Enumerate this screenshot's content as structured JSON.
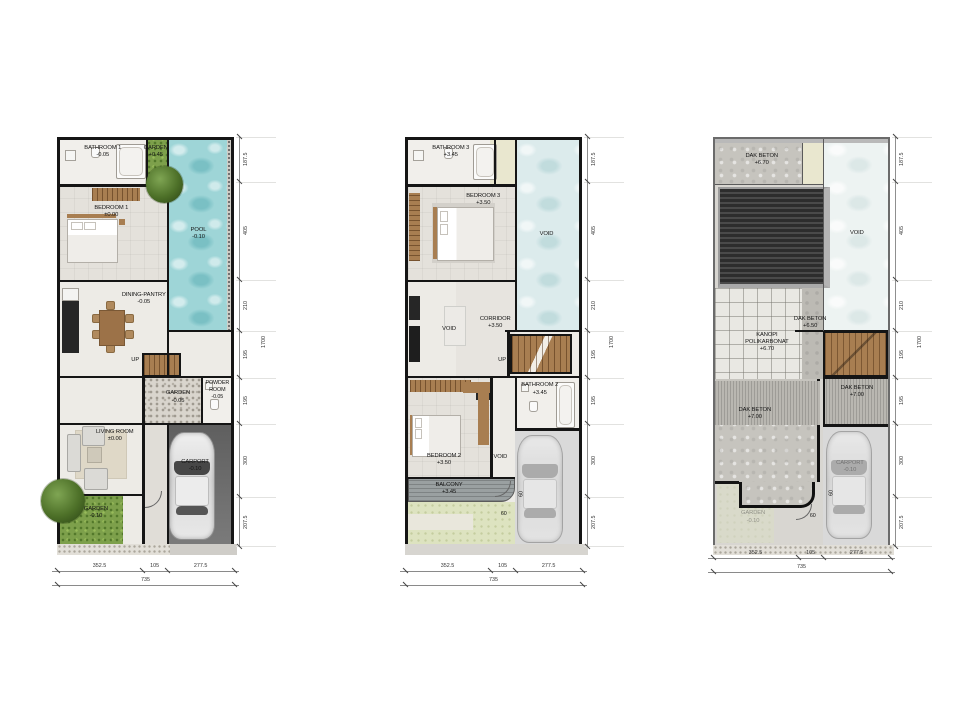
{
  "dims": {
    "right": [
      "187.5",
      "405",
      "210",
      "195",
      "195",
      "300",
      "207.5"
    ],
    "right_total": "1700",
    "bottom": [
      "352.5",
      "105",
      "277.5"
    ],
    "bottom_total": "735",
    "offset": "60"
  },
  "plans": [
    {
      "rooms": {
        "bathroom1": {
          "name": "BATHROOM 1",
          "level": "-0.05"
        },
        "garden_top": {
          "name": "GARDEN",
          "level": "+0.45"
        },
        "bedroom1": {
          "name": "BEDROOM 1",
          "level": "±0.00"
        },
        "pool": {
          "name": "POOL",
          "level": "-0.10"
        },
        "dining": {
          "name": "DINING-PANTRY",
          "level": "-0.05"
        },
        "stairs": {
          "name": "UP"
        },
        "garden_mid": {
          "name": "GARDEN",
          "level": "-0.05"
        },
        "powder": {
          "name": "POWDER ROOM",
          "level": "-0.05"
        },
        "living": {
          "name": "LIVING ROOM",
          "level": "±0.00"
        },
        "carport": {
          "name": "CARPORT",
          "level": "-0.10"
        },
        "garden_bottom": {
          "name": "GARDEN",
          "level": "-0.10"
        }
      }
    },
    {
      "rooms": {
        "bathroom3": {
          "name": "BATHROOM 3",
          "level": "+3.45"
        },
        "bedroom3": {
          "name": "BEDROOM 3",
          "level": "+3.50"
        },
        "void_pool": {
          "name": "VOID"
        },
        "corridor": {
          "name": "CORRIDOR",
          "level": "+3.50"
        },
        "void_left": {
          "name": "VOID"
        },
        "stairs": {
          "name": "UP"
        },
        "bathroom2": {
          "name": "BATHROOM 2",
          "level": "+3.45"
        },
        "bedroom2": {
          "name": "BEDROOM 2",
          "level": "+3.50"
        },
        "void_entry": {
          "name": "VOID"
        },
        "balcony": {
          "name": "BALCONY",
          "level": "+3.45"
        }
      }
    },
    {
      "rooms": {
        "dak_beton_top": {
          "name": "DAK BETON",
          "level": "+6.70"
        },
        "void": {
          "name": "VOID"
        },
        "dak_beton_mid": {
          "name": "DAK BETON",
          "level": "+6.50"
        },
        "kanopi": {
          "name": "KANOPI POLIKARBONAT",
          "level": "+6.70"
        },
        "dak_beton_right": {
          "name": "DAK BETON",
          "level": "+7.00"
        },
        "dak_beton_left": {
          "name": "DAK BETON",
          "level": "+7.00"
        },
        "garden": {
          "name": "GARDEN",
          "level": "-0.10"
        },
        "carport": {
          "name": "CARPORT",
          "level": "-0.10"
        }
      }
    }
  ]
}
